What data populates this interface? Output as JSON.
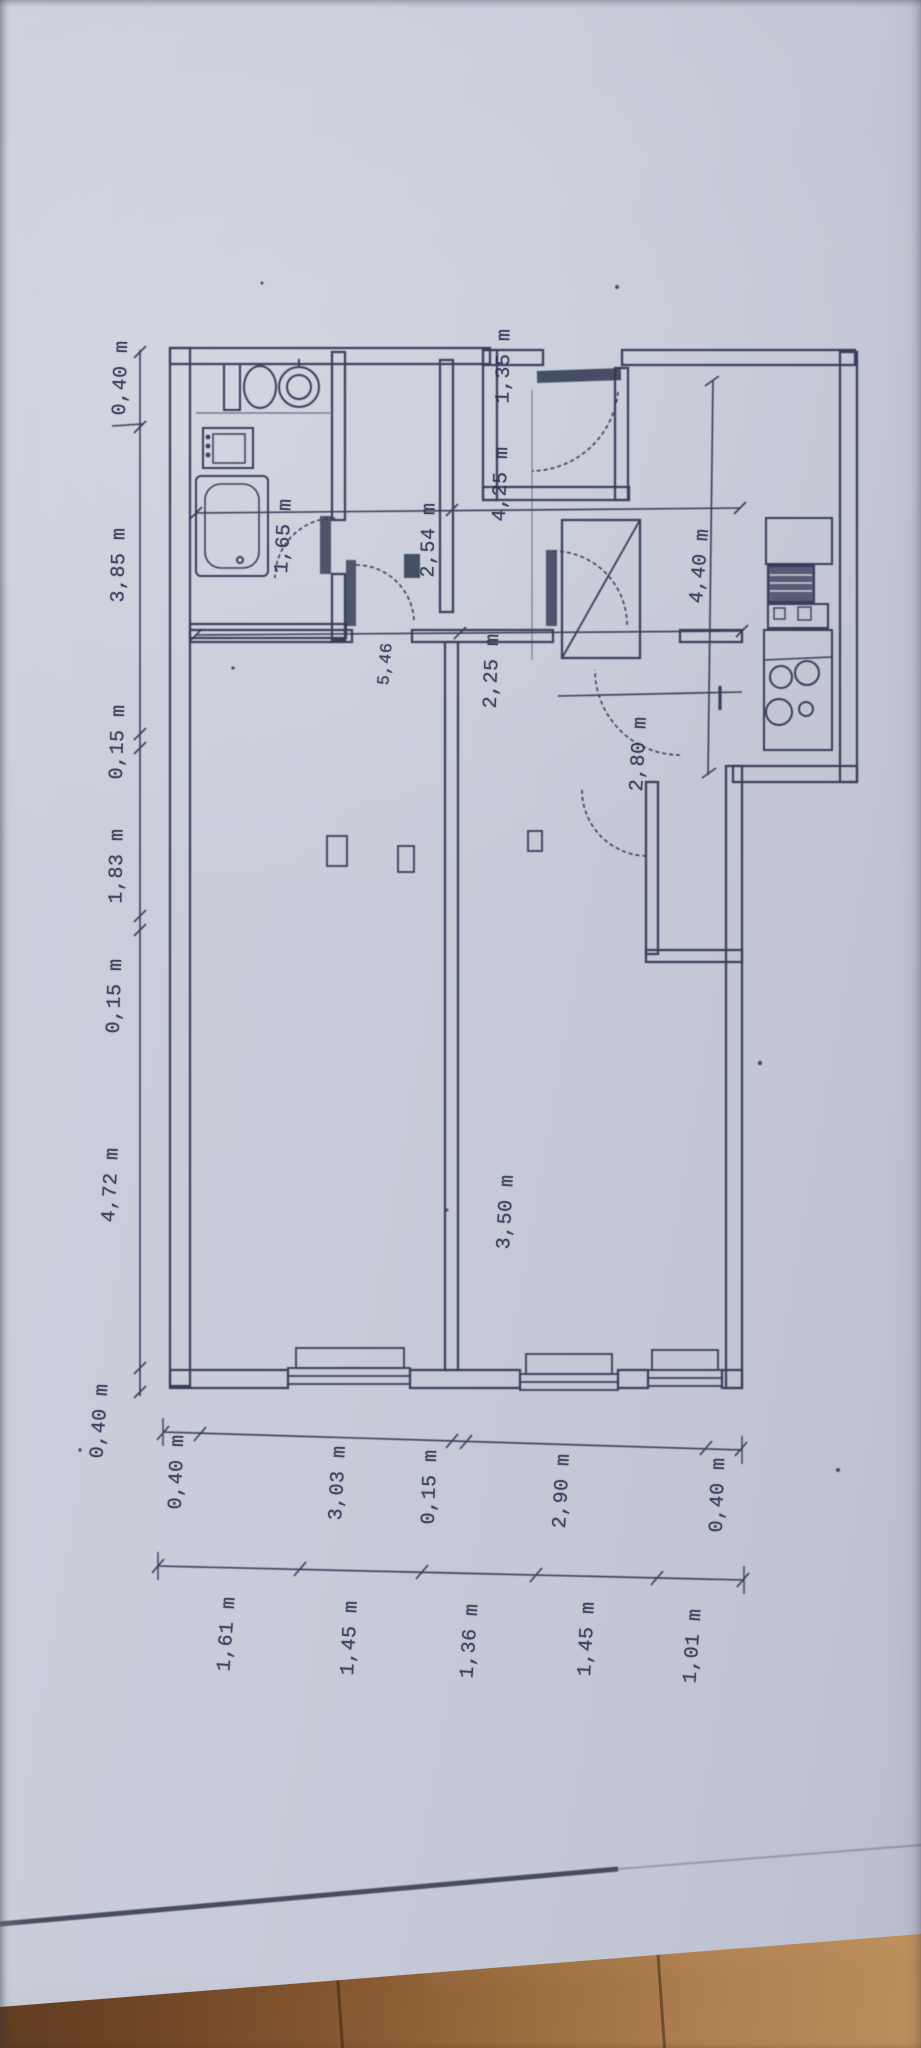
{
  "document": {
    "kind": "floor-plan photo, drawing rotated 90 degrees",
    "unit": "m"
  },
  "dims": {
    "left_chain": [
      "0,40 m",
      "3,85 m",
      "0,15 m",
      "1,83 m",
      "0,15 m",
      "4,72 m",
      "0,40 m"
    ],
    "bottom_outer": [
      "0,40 m",
      "3,03 m",
      "0,15 m",
      "2,90 m",
      "0,40 m"
    ],
    "bottom_inner": [
      "1,61 m",
      "1,45 m",
      "1,36 m",
      "1,45 m",
      "1,01 m"
    ],
    "interior": [
      "1,35 m",
      "1,65 m",
      "2,54 m",
      "4,25 m",
      "2,80 m",
      "4,40 m",
      "2,25 m",
      "5,46",
      "3,50 m"
    ]
  },
  "fixtures": [
    "toilet",
    "washbasin",
    "washing-machine",
    "bathtub",
    "kitchen-counter",
    "stove",
    "kitchen-sink",
    "wardrobe",
    "radiator"
  ],
  "colors": {
    "paper": "#c8cbd9",
    "ink": "#2c3150",
    "wood_dark": "#5e3a1f",
    "wood_light": "#bd8f5c"
  }
}
